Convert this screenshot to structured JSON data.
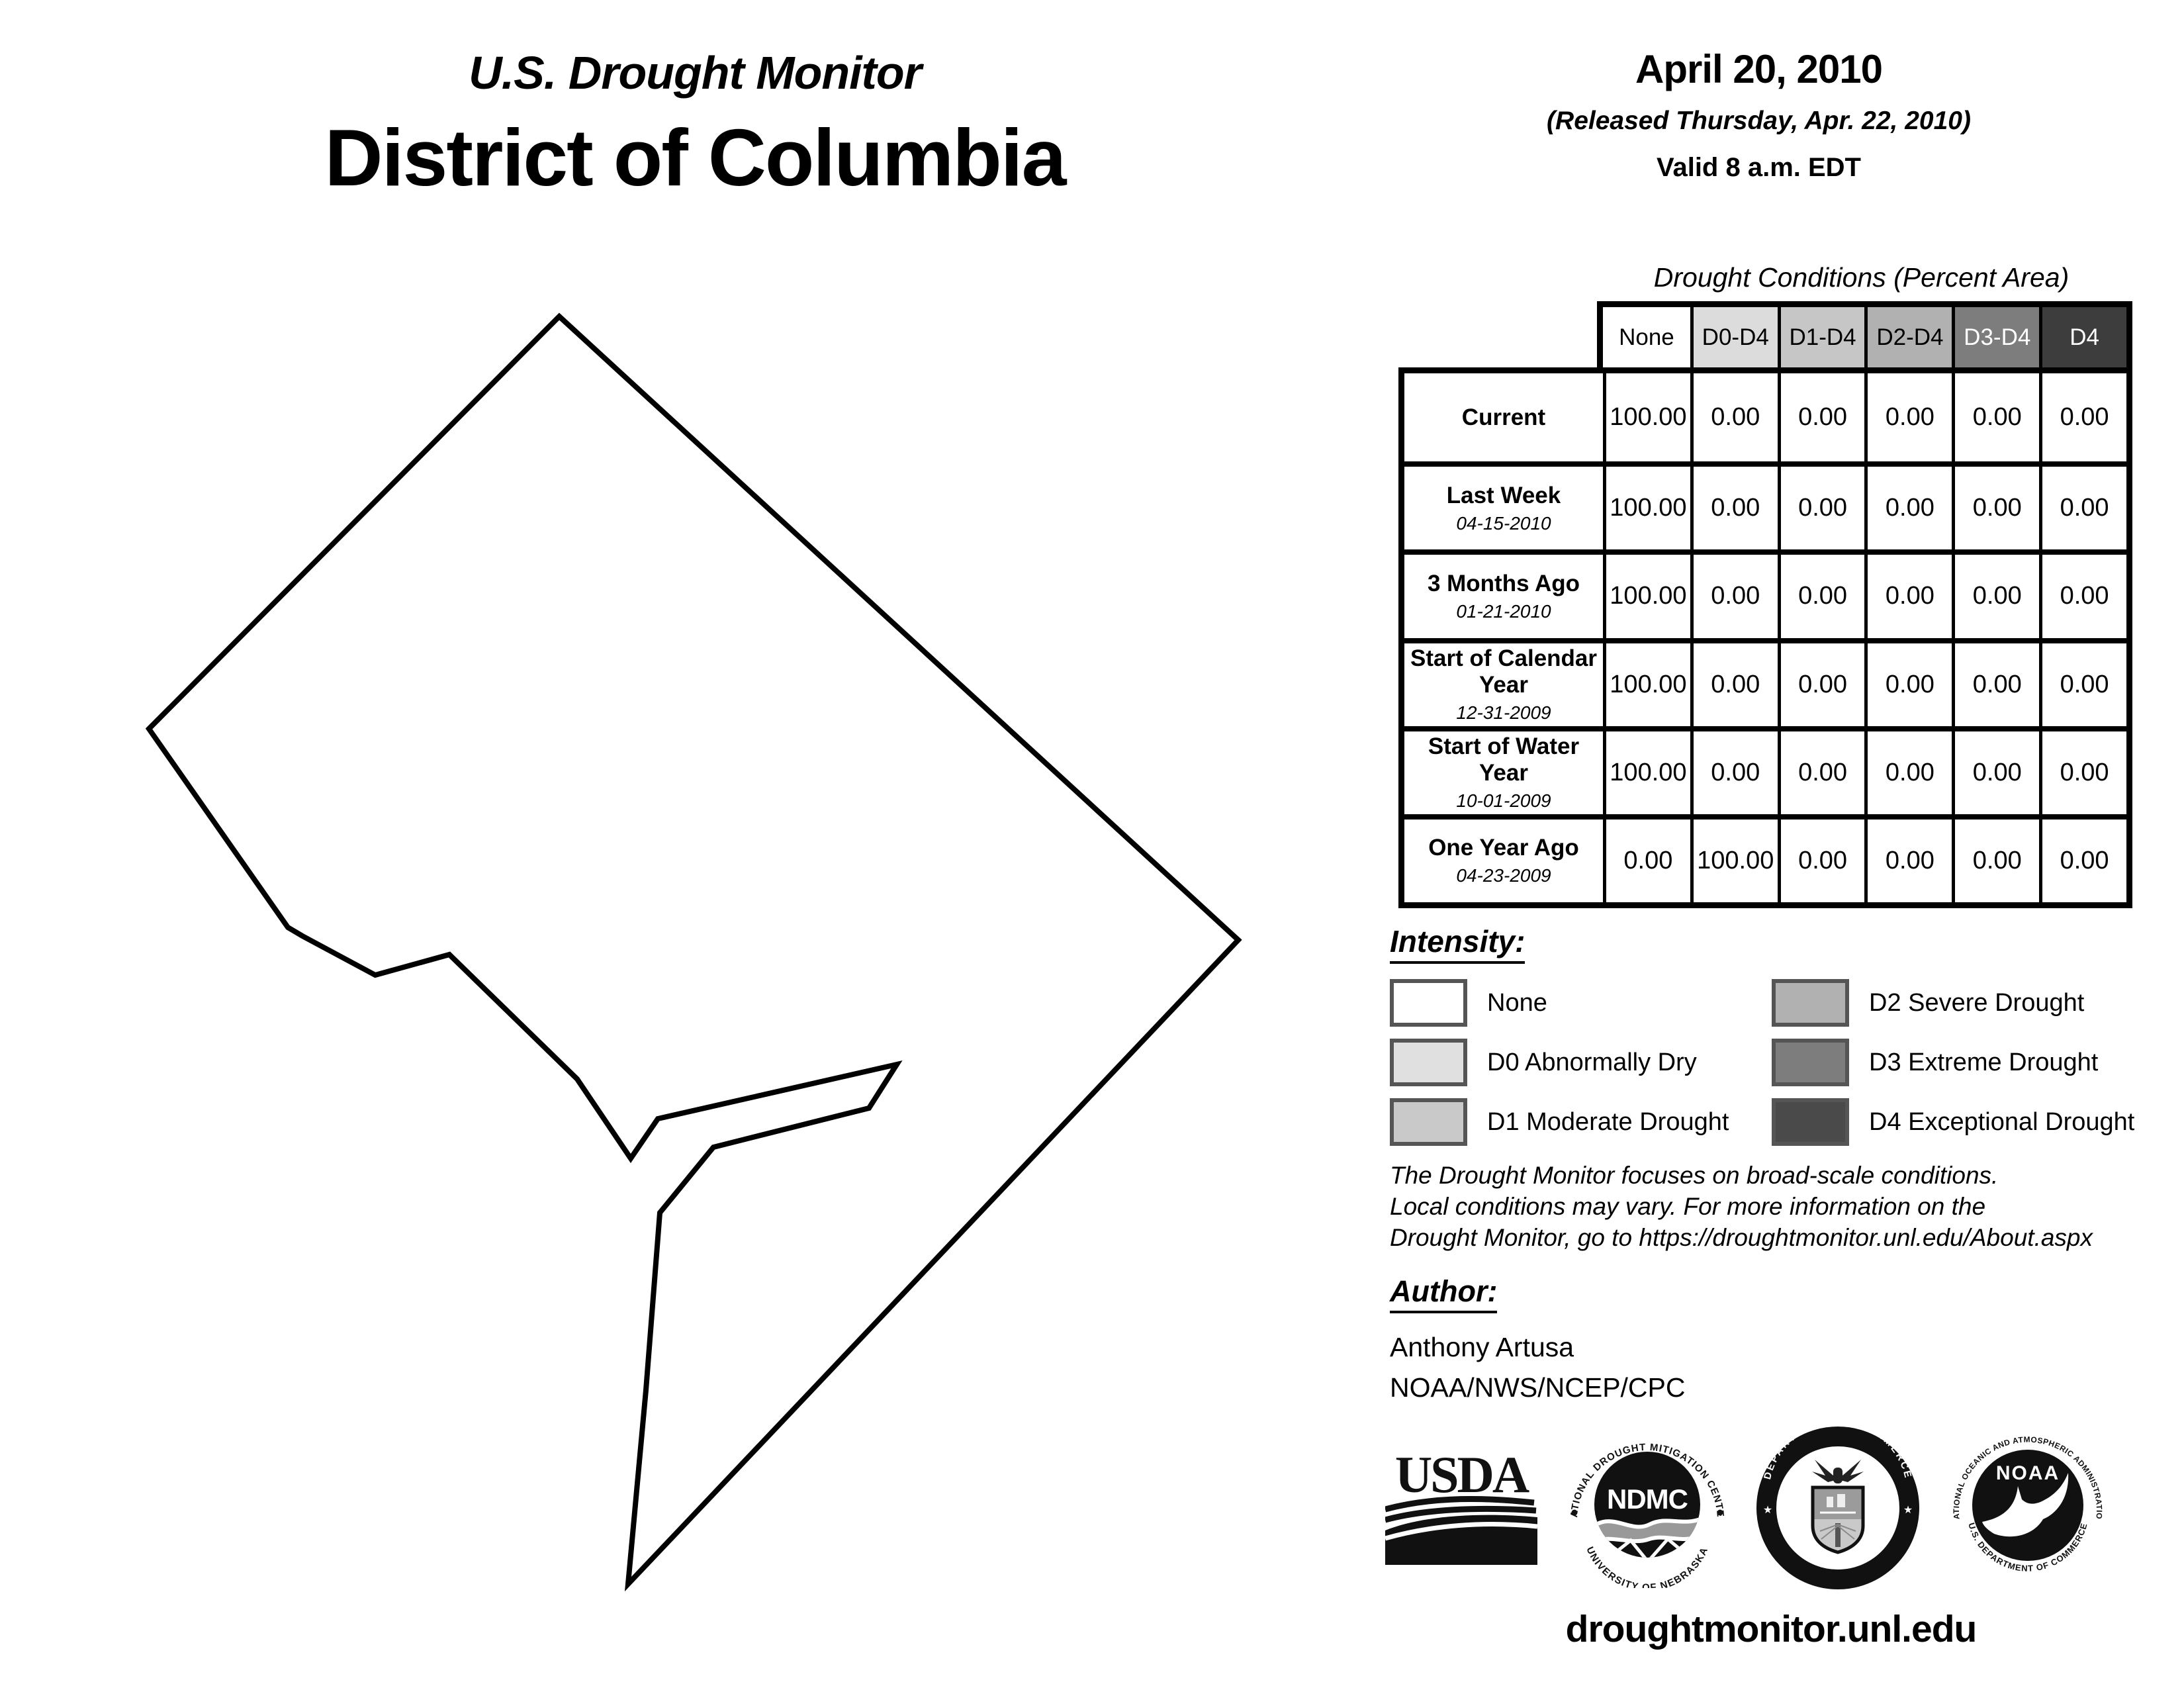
{
  "header": {
    "title": "U.S. Drought Monitor",
    "region": "District of Columbia",
    "date": "April 20, 2010",
    "released": "(Released Thursday, Apr. 22, 2010)",
    "valid": "Valid 8 a.m. EDT"
  },
  "table": {
    "title": "Drought Conditions (Percent Area)",
    "columns": [
      {
        "label": "None",
        "bg": "#ffffff",
        "fg": "#000000"
      },
      {
        "label": "D0-D4",
        "bg": "#dcdcdc",
        "fg": "#000000"
      },
      {
        "label": "D1-D4",
        "bg": "#c6c6c6",
        "fg": "#000000"
      },
      {
        "label": "D2-D4",
        "bg": "#b1b1b1",
        "fg": "#000000"
      },
      {
        "label": "D3-D4",
        "bg": "#7d7d7d",
        "fg": "#ffffff"
      },
      {
        "label": "D4",
        "bg": "#3d3d3d",
        "fg": "#ffffff"
      }
    ],
    "rows": [
      {
        "label": "Current",
        "date": "",
        "values": [
          "100.00",
          "0.00",
          "0.00",
          "0.00",
          "0.00",
          "0.00"
        ]
      },
      {
        "label": "Last Week",
        "date": "04-15-2010",
        "values": [
          "100.00",
          "0.00",
          "0.00",
          "0.00",
          "0.00",
          "0.00"
        ]
      },
      {
        "label": "3 Months Ago",
        "date": "01-21-2010",
        "values": [
          "100.00",
          "0.00",
          "0.00",
          "0.00",
          "0.00",
          "0.00"
        ]
      },
      {
        "label": "Start of Calendar Year",
        "date": "12-31-2009",
        "values": [
          "100.00",
          "0.00",
          "0.00",
          "0.00",
          "0.00",
          "0.00"
        ]
      },
      {
        "label": "Start of Water Year",
        "date": "10-01-2009",
        "values": [
          "100.00",
          "0.00",
          "0.00",
          "0.00",
          "0.00",
          "0.00"
        ]
      },
      {
        "label": "One Year Ago",
        "date": "04-23-2009",
        "values": [
          "0.00",
          "100.00",
          "0.00",
          "0.00",
          "0.00",
          "0.00"
        ]
      }
    ]
  },
  "legend": {
    "heading": "Intensity:",
    "items": [
      {
        "label": "None",
        "color": "#ffffff"
      },
      {
        "label": "D0 Abnormally Dry",
        "color": "#e0e0e0"
      },
      {
        "label": "D1 Moderate Drought",
        "color": "#c9c9c9"
      },
      {
        "label": "D2 Severe Drought",
        "color": "#b1b1b1"
      },
      {
        "label": "D3 Extreme Drought",
        "color": "#7d7d7d"
      },
      {
        "label": "D4 Exceptional Drought",
        "color": "#4a4a4a"
      }
    ]
  },
  "disclaimer": {
    "line1": "The Drought Monitor focuses on broad-scale conditions.",
    "line2": "Local conditions may vary. For more information on the",
    "line3": "Drought Monitor, go to https://droughtmonitor.unl.edu/About.aspx"
  },
  "author": {
    "heading": "Author:",
    "name": "Anthony Artusa",
    "org": "NOAA/NWS/NCEP/CPC"
  },
  "footer": {
    "url": "droughtmonitor.unl.edu",
    "logos": {
      "usda": {
        "text": "USDA"
      },
      "ndmc": {
        "text": "NDMC",
        "ring_top": "NATIONAL DROUGHT MITIGATION CENTER",
        "ring_bottom": "UNIVERSITY OF NEBRASKA"
      },
      "doc": {
        "ring_top": "DEPARTMENT OF COMMERCE",
        "ring_bottom": "UNITED STATES OF AMERICA"
      },
      "noaa": {
        "text": "NOAA",
        "ring_top": "NATIONAL OCEANIC AND ATMOSPHERIC ADMINISTRATION",
        "ring_bottom": "U.S. DEPARTMENT OF COMMERCE"
      }
    }
  }
}
